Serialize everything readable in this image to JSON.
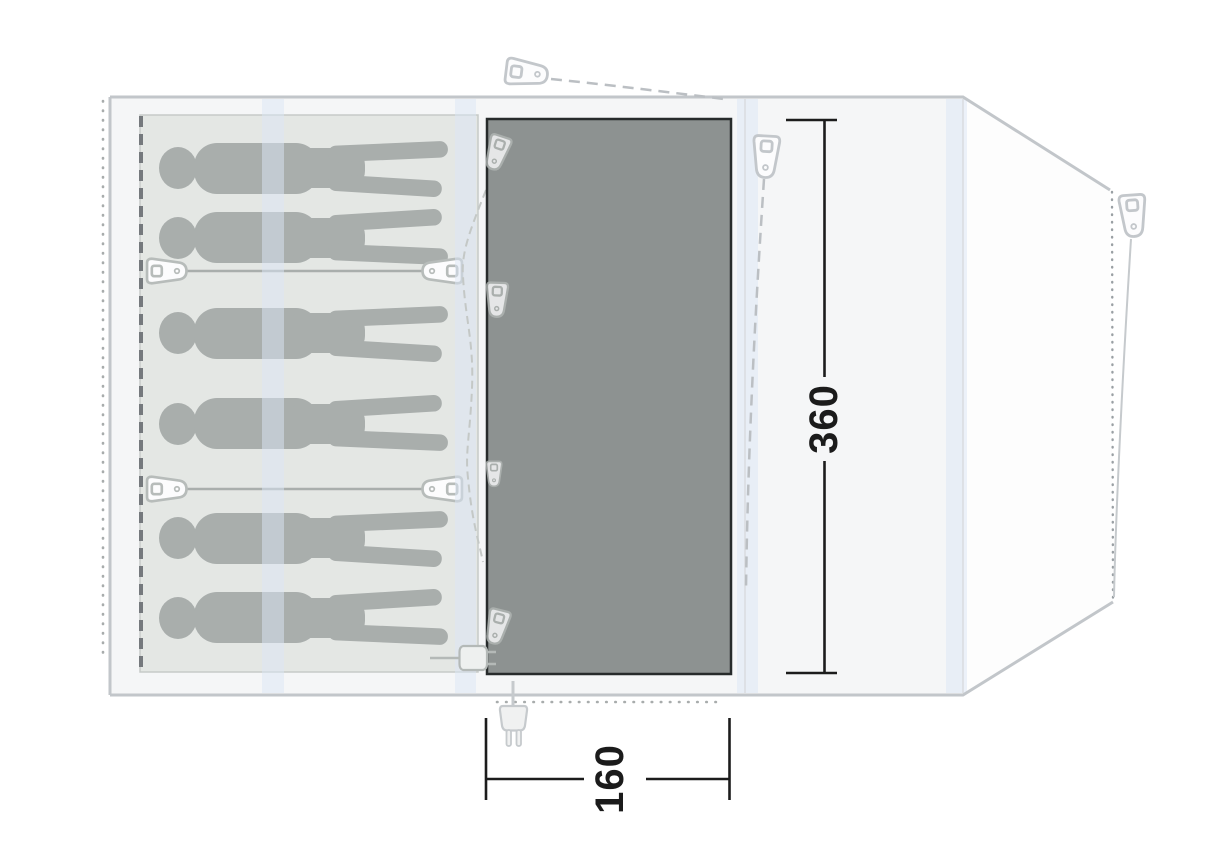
{
  "dimensions": {
    "depth_cm": "360",
    "entrance_width_cm": "160"
  },
  "sleeping_area": {
    "capacity": 6
  },
  "colors": {
    "tent_outline": "#c2c6ca",
    "tent_fill": "#f5f6f7",
    "cabin_fill": "#e4e7e4",
    "cabin_dashed_edge": "#75797d",
    "groundsheet_fill": "#8d9291",
    "groundsheet_border": "#272b2b",
    "silhouette": "#a6abaa",
    "pole_stripe": "#dce5f6",
    "guy_line": "#bbbfc3",
    "dimension": "#1b1b1b"
  },
  "icons": {
    "tent_peg_count": 3,
    "strap_buckle_count": 4,
    "zipper_pull_count": 4,
    "power_plug": "power-plug-icon",
    "cable_entry": "cable-entry-icon"
  }
}
